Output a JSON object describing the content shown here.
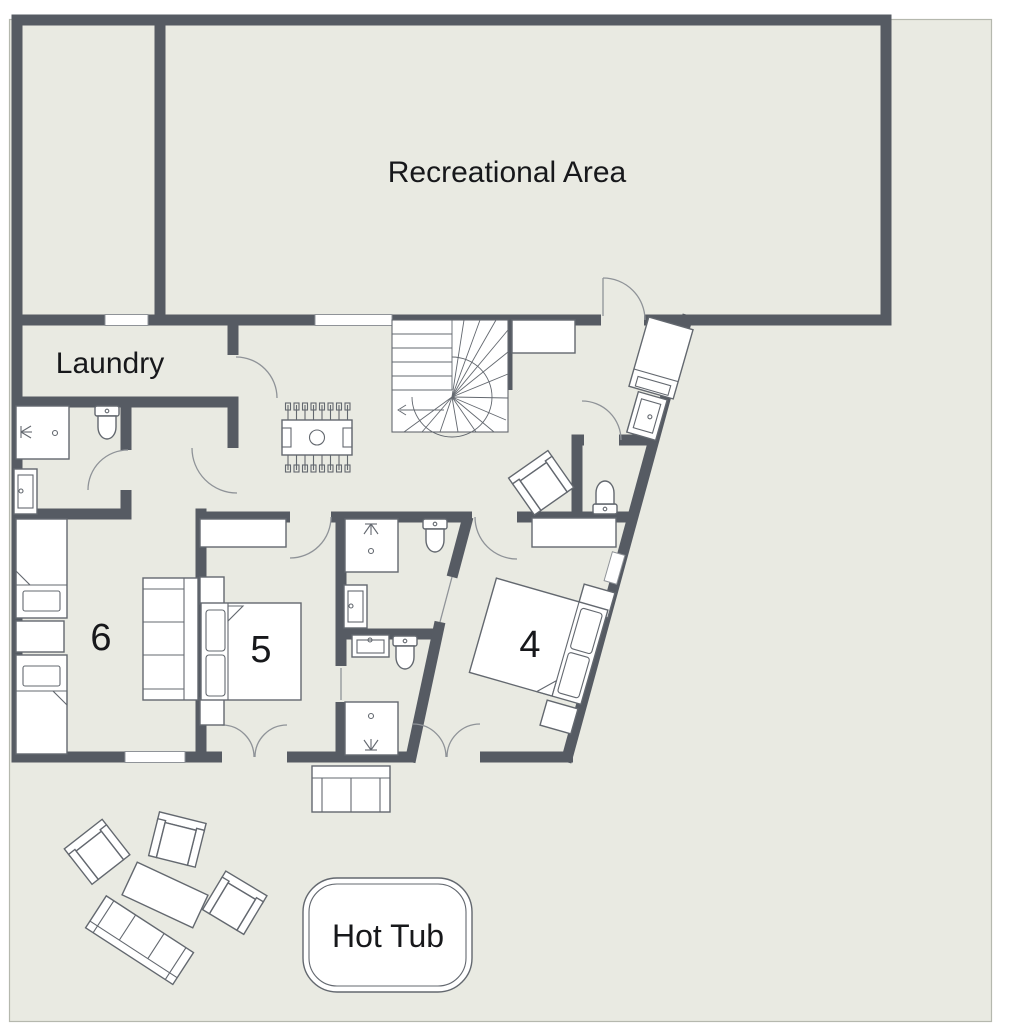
{
  "plan": {
    "rooms": {
      "recreational_area": "Recreational Area",
      "laundry": "Laundry",
      "bedroom_6": "6",
      "bedroom_5": "5",
      "bedroom_4": "4",
      "hot_tub": "Hot Tub"
    },
    "colors": {
      "wall": "#565b63",
      "floor": "#e9eae2",
      "fixture": "#63686f",
      "door": "#8f9398",
      "text": "#17181b",
      "patio_border": "#b5b8ae",
      "background": "#ffffff"
    },
    "symbols": [
      "winder-staircase",
      "foosball-table",
      "toilet",
      "sink",
      "shower",
      "single-bed",
      "double-bed",
      "sofa",
      "armchair",
      "wardrobe",
      "nightstand",
      "outdoor-table",
      "loveseat",
      "hot-tub",
      "door-arc",
      "window"
    ]
  }
}
